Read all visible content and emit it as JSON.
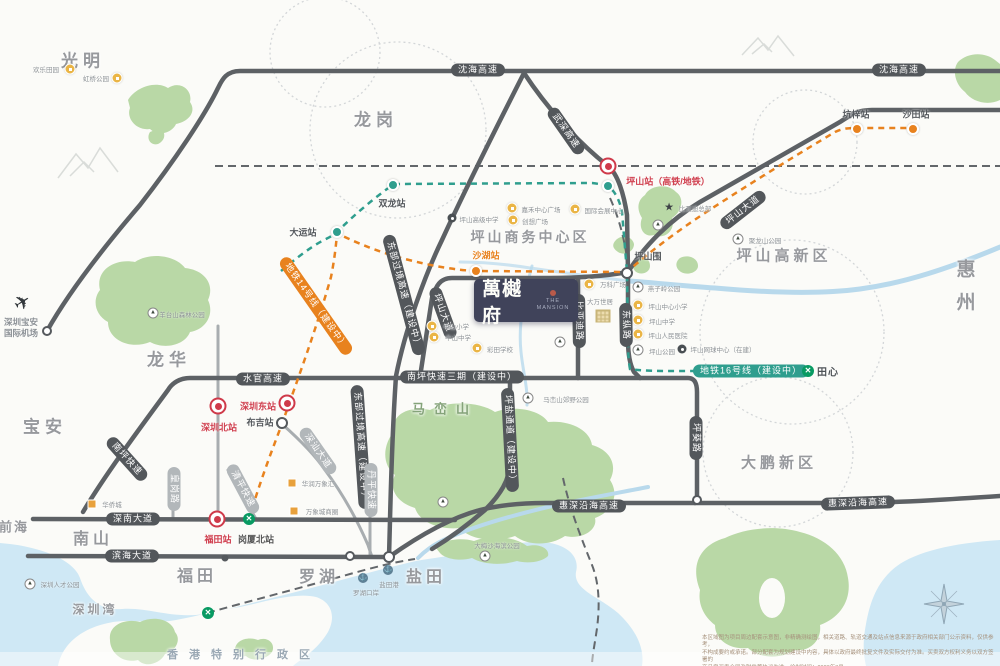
{
  "project": {
    "name": "萬樾府",
    "sub": "THE MANSION"
  },
  "regions": [
    {
      "t": "光明",
      "x": 83,
      "y": 59,
      "s": 17,
      "ls": 5
    },
    {
      "t": "龙岗",
      "x": 376,
      "y": 118,
      "s": 17,
      "ls": 5
    },
    {
      "t": "龙华",
      "x": 169,
      "y": 358,
      "s": 17,
      "ls": 5
    },
    {
      "t": "宝安",
      "x": 45,
      "y": 425,
      "s": 17,
      "ls": 5
    },
    {
      "t": "南山",
      "x": 93,
      "y": 537,
      "s": 16,
      "ls": 4
    },
    {
      "t": "福田",
      "x": 197,
      "y": 574,
      "s": 16,
      "ls": 4
    },
    {
      "t": "罗湖",
      "x": 319,
      "y": 575,
      "s": 16,
      "ls": 4
    },
    {
      "t": "盐田",
      "x": 426,
      "y": 575,
      "s": 16,
      "ls": 4
    },
    {
      "t": "前海",
      "x": 14,
      "y": 526,
      "s": 13,
      "ls": 2
    },
    {
      "t": "深圳湾",
      "x": 95,
      "y": 609,
      "s": 12,
      "ls": 3
    },
    {
      "t": "惠州",
      "x": 964,
      "y": 292,
      "s": 19,
      "ls": 14,
      "v": true
    },
    {
      "t": "大鹏新区",
      "x": 779,
      "y": 462,
      "s": 15,
      "ls": 4
    },
    {
      "t": "马峦山",
      "x": 445,
      "y": 408,
      "s": 13,
      "ls": 9,
      "c": "#85a37a"
    },
    {
      "t": "坪山商务中心区",
      "x": 530,
      "y": 237,
      "s": 14,
      "ls": 3
    },
    {
      "t": "坪山高新区",
      "x": 784,
      "y": 255,
      "s": 15,
      "ls": 4
    },
    {
      "t": "香港特别行政区",
      "x": 244,
      "y": 654,
      "s": 11,
      "ls": 11,
      "c": "#9aa8b4"
    },
    {
      "t": "田心",
      "x": 828,
      "y": 371,
      "s": 10,
      "ls": 1,
      "c": "#4e5357"
    }
  ],
  "road_pills": [
    {
      "t": "沈海高速",
      "x": 478,
      "y": 70,
      "r": 0,
      "st": "dark"
    },
    {
      "t": "沈海高速",
      "x": 899,
      "y": 70,
      "r": 0,
      "st": "dark"
    },
    {
      "t": "武深高速",
      "x": 566,
      "y": 131,
      "r": 55,
      "st": "dark"
    },
    {
      "t": "坪山大道",
      "x": 743,
      "y": 210,
      "r": -38,
      "st": "dark"
    },
    {
      "t": "坪山大道",
      "x": 443,
      "y": 313,
      "r": 70,
      "st": "dark"
    },
    {
      "t": "东部过境高速（建设中）",
      "x": 404,
      "y": 295,
      "r": 75,
      "st": "dark"
    },
    {
      "t": "东部过境高速（建设中）",
      "x": 361,
      "y": 447,
      "r": 86,
      "st": "dark"
    },
    {
      "t": "水官高速",
      "x": 263,
      "y": 379,
      "r": 0,
      "st": "dark"
    },
    {
      "t": "南坪快速",
      "x": 127,
      "y": 459,
      "r": 48,
      "st": "dark"
    },
    {
      "t": "南坪快速三期（建设中）",
      "x": 462,
      "y": 377,
      "r": 0,
      "st": "dark"
    },
    {
      "t": "坪盐通道（建设中）",
      "x": 510,
      "y": 440,
      "r": 87,
      "st": "dark"
    },
    {
      "t": "坪葵路",
      "x": 696,
      "y": 438,
      "r": 90,
      "st": "dark"
    },
    {
      "t": "东纵路",
      "x": 626,
      "y": 325,
      "r": 89,
      "st": "dark"
    },
    {
      "t": "比亚迪路",
      "x": 579,
      "y": 321,
      "r": 89,
      "st": "dark"
    },
    {
      "t": "惠深沿海高速",
      "x": 589,
      "y": 506,
      "r": 0,
      "st": "dark"
    },
    {
      "t": "惠深沿海高速",
      "x": 858,
      "y": 503,
      "r": -2,
      "st": "dark"
    },
    {
      "t": "深南大道",
      "x": 133,
      "y": 519,
      "r": 0,
      "st": "dark"
    },
    {
      "t": "滨海大道",
      "x": 132,
      "y": 556,
      "r": 0,
      "st": "dark"
    },
    {
      "t": "深汕大道",
      "x": 318,
      "y": 451,
      "r": 55,
      "st": "gray"
    },
    {
      "t": "皇岗路",
      "x": 174,
      "y": 489,
      "r": 90,
      "st": "gray"
    },
    {
      "t": "清平快速",
      "x": 243,
      "y": 489,
      "r": 62,
      "st": "gray"
    },
    {
      "t": "丹平快速",
      "x": 371,
      "y": 490,
      "r": 90,
      "st": "gray"
    },
    {
      "t": "地铁14号线（建设中）",
      "x": 316,
      "y": 306,
      "r": 55,
      "st": "orange"
    },
    {
      "t": "地铁16号线（建设中）",
      "x": 751,
      "y": 371,
      "r": 0,
      "st": "teal"
    }
  ],
  "stations": [
    {
      "icon": "rail",
      "x": 608,
      "y": 166,
      "t": "坪山站（高铁/地铁）",
      "lx": 668,
      "ly": 181,
      "lc": "#d0404f"
    },
    {
      "icon": "rail",
      "x": 218,
      "y": 406,
      "t": "深圳北站",
      "lx": 219,
      "ly": 427,
      "lc": "#d0404f"
    },
    {
      "icon": "rail",
      "x": 287,
      "y": 403,
      "t": "深圳东站",
      "lx": 258,
      "ly": 406,
      "lc": "#d0404f"
    },
    {
      "icon": "rail",
      "x": 217,
      "y": 519,
      "t": "福田站",
      "lx": 218,
      "ly": 539,
      "lc": "#d0404f"
    },
    {
      "icon": "metro",
      "x": 249,
      "y": 519,
      "t": "岗厦北站",
      "lx": 256,
      "ly": 539,
      "lc": "#555"
    },
    {
      "icon": "metro",
      "x": 208,
      "y": 613
    },
    {
      "icon": "metro",
      "x": 808,
      "y": 371
    },
    {
      "icon": "odot",
      "x": 476,
      "y": 271,
      "t": "沙湖站",
      "lx": 486,
      "ly": 255,
      "lc": "#e8821e"
    },
    {
      "icon": "odot",
      "x": 857,
      "y": 129,
      "t": "坑梓站",
      "lx": 856,
      "ly": 114,
      "lc": "#55595d"
    },
    {
      "icon": "odot",
      "x": 913,
      "y": 129,
      "t": "沙田站",
      "lx": 916,
      "ly": 114,
      "lc": "#55595d"
    },
    {
      "icon": "tdot",
      "x": 337,
      "y": 232,
      "t": "大运站",
      "lx": 303,
      "ly": 232,
      "lc": "#55595d"
    },
    {
      "icon": "tdot",
      "x": 393,
      "y": 185,
      "t": "双龙站",
      "lx": 392,
      "ly": 203,
      "lc": "#55595d"
    },
    {
      "icon": "tdot",
      "x": 608,
      "y": 186
    },
    {
      "icon": "ring",
      "x": 627,
      "y": 273,
      "t": "坪山围",
      "lx": 648,
      "ly": 256,
      "lc": "#55595d"
    },
    {
      "icon": "ring",
      "x": 282,
      "y": 423,
      "t": "布吉站",
      "lx": 260,
      "ly": 422,
      "lc": "#55595d"
    }
  ],
  "pois": [
    {
      "icon": "sch",
      "x": 70,
      "y": 69,
      "t": "欢乐田园",
      "lx": 46,
      "ly": 69
    },
    {
      "icon": "sch",
      "x": 117,
      "y": 78,
      "t": "虹桥公园",
      "lx": 96,
      "ly": 78
    },
    {
      "icon": "mtn",
      "x": 153,
      "y": 313,
      "t": "羊台山森林公园",
      "lx": 182,
      "ly": 314
    },
    {
      "icon": "blk",
      "x": 452,
      "y": 218,
      "t": "坪山高级中学",
      "lx": 479,
      "ly": 219
    },
    {
      "icon": "sch",
      "x": 512,
      "y": 208,
      "t": "嘉禾中心广场",
      "lx": 541,
      "ly": 209
    },
    {
      "icon": "sch",
      "x": 513,
      "y": 220,
      "t": "创想广场",
      "lx": 535,
      "ly": 221
    },
    {
      "icon": "sch",
      "x": 575,
      "y": 209,
      "t": "国际会展中心",
      "lx": 604,
      "ly": 210
    },
    {
      "icon": "sch",
      "x": 589,
      "y": 284,
      "t": "万科广场",
      "lx": 613,
      "ly": 284
    },
    {
      "icon": "her",
      "x": 603,
      "y": 316,
      "t": "大万世居",
      "lx": 600,
      "ly": 301
    },
    {
      "icon": "star",
      "x": 669,
      "y": 208,
      "t": "比亚迪总部",
      "lx": 695,
      "ly": 208
    },
    {
      "icon": "mtn",
      "x": 658,
      "y": 225
    },
    {
      "icon": "mtn",
      "x": 738,
      "y": 239,
      "t": "聚龙山公园",
      "lx": 765,
      "ly": 240
    },
    {
      "icon": "mtn",
      "x": 638,
      "y": 287,
      "t": "燕子岭公园",
      "lx": 664,
      "ly": 288
    },
    {
      "icon": "sch",
      "x": 638,
      "y": 305,
      "t": "坪山中心小学",
      "lx": 668,
      "ly": 306
    },
    {
      "icon": "sch",
      "x": 638,
      "y": 320,
      "t": "坪山中学",
      "lx": 662,
      "ly": 321
    },
    {
      "icon": "sch",
      "x": 638,
      "y": 334,
      "t": "坪山人民医院",
      "lx": 668,
      "ly": 335
    },
    {
      "icon": "mtn",
      "x": 638,
      "y": 350,
      "t": "坪山公园",
      "lx": 662,
      "ly": 351
    },
    {
      "icon": "blk",
      "x": 682,
      "y": 349,
      "t": "坪山网球中心（在建）",
      "lx": 723,
      "ly": 349
    },
    {
      "icon": "sch",
      "x": 432,
      "y": 326,
      "t": "中山小学",
      "lx": 456,
      "ly": 326
    },
    {
      "icon": "sch",
      "x": 434,
      "y": 337,
      "t": "中山中学",
      "lx": 458,
      "ly": 337
    },
    {
      "icon": "sch",
      "x": 477,
      "y": 348,
      "t": "彩田学校",
      "lx": 500,
      "ly": 349
    },
    {
      "icon": "mtn",
      "x": 560,
      "y": 342
    },
    {
      "icon": "mtn",
      "x": 528,
      "y": 398,
      "t": "马峦山郊野公园",
      "lx": 566,
      "ly": 399
    },
    {
      "icon": "mtn",
      "x": 443,
      "y": 502
    },
    {
      "icon": "mtn",
      "x": 485,
      "y": 556,
      "t": "大梅沙海滨公园",
      "lx": 497,
      "ly": 545
    },
    {
      "icon": "port",
      "x": 388,
      "y": 570,
      "t": "盐田港",
      "lx": 389,
      "ly": 584
    },
    {
      "icon": "port",
      "x": 363,
      "y": 578,
      "t": "罗湖口岸",
      "lx": 366,
      "ly": 592
    },
    {
      "icon": "sq",
      "x": 292,
      "y": 483,
      "t": "华润万象汇",
      "lx": 318,
      "ly": 483
    },
    {
      "icon": "sq",
      "x": 294,
      "y": 511,
      "t": "万象城商圈",
      "lx": 322,
      "ly": 511
    },
    {
      "icon": "sq",
      "x": 92,
      "y": 504,
      "t": "华侨城",
      "lx": 112,
      "ly": 504
    },
    {
      "icon": "mtn",
      "x": 30,
      "y": 584,
      "t": "深圳人才公园",
      "lx": 60,
      "ly": 584
    }
  ],
  "airport": {
    "line1": "深圳宝安",
    "line2": "国际机场"
  },
  "metro16_note": "地铁16号线（建设中）",
  "disclaimer": {
    "l1": "本区域图为项目周边配套示意图，非精确测绘图，相关道路、轨道交通及站点信息来源于政府相关部门公示资料，仅供参考，",
    "l2": "不构成要约或承诺。部分配套为规划建设中内容，具体以政府最终批复文件及实际交付为准。买卖双方权利义务以双方签署的",
    "l3": "商品房买卖合同及附件等协议为准。绘制时间：2023年3月"
  }
}
